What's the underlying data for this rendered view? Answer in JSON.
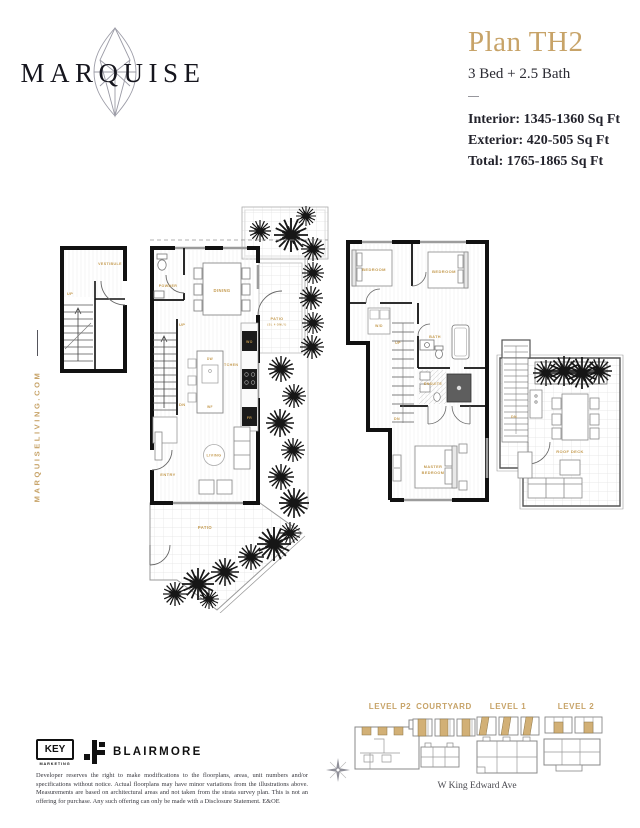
{
  "colors": {
    "accent_gold": "#C7A368",
    "label_gold": "#C49A4E",
    "keyplan_gold": "#D2B076",
    "ink": "#17171F"
  },
  "brand": {
    "wordmark": "MARQUISE",
    "website": "MARQUISELIVING.COM",
    "gem_icon": "marquise-gem-icon"
  },
  "plan_header": {
    "title": "Plan TH2",
    "configuration": "3 Bed + 2.5 Bath",
    "interior": "Interior: 1345-1360 Sq Ft",
    "exterior": "Exterior: 420-505 Sq Ft",
    "total": "Total: 1765-1865 Sq Ft"
  },
  "level1_plan": {
    "labels": {
      "vestibule": "VESTIBULE",
      "vestibule_up": "UP",
      "powder": "POWDER",
      "dining": "DINING",
      "up": "UP",
      "dn": "DN",
      "entry": "ENTRY",
      "living": "LIVING",
      "kitchen": "KITCHEN",
      "dw": "DW",
      "wf": "WF",
      "wo": "WO",
      "fr": "FR",
      "patio_upper": "PATIO",
      "patio_upper_note": "(SL 4 ONLY)",
      "patio_lower": "PATIO"
    }
  },
  "level2_plan": {
    "labels": {
      "bedroom_left": "BEDROOM",
      "bedroom_right": "BEDROOM",
      "wd": "W/D",
      "up": "UP",
      "dn": "DN",
      "bath": "BATH",
      "ensuite": "ENSUITE",
      "master_line1": "MASTER",
      "master_line2": "BEDROOM"
    }
  },
  "roof_deck_plan": {
    "labels": {
      "dn": "DN",
      "title": "ROOF DECK"
    }
  },
  "keyplans": {
    "items": [
      {
        "label": "LEVEL P2"
      },
      {
        "label": "COURTYARD"
      },
      {
        "label": "LEVEL 1"
      },
      {
        "label": "LEVEL 2"
      }
    ],
    "street": "W King Edward Ave",
    "compass_icon": "compass-rose-icon"
  },
  "footer": {
    "key_marketing": {
      "line1": "KEY",
      "line2": "MARKETING"
    },
    "blairmore": "BLAIRMORE",
    "disclaimer": "Developer reserves the right to make modifications to the floorplans, areas, unit numbers and/or specifications without notice. Actual floorplans may have minor variations from the illustrations above. Measurements are based on architectural areas and not taken from the strata survey plan. This is not an offering for purchase. Any such offering can only be made with a Disclosure Statement. E&OE"
  }
}
